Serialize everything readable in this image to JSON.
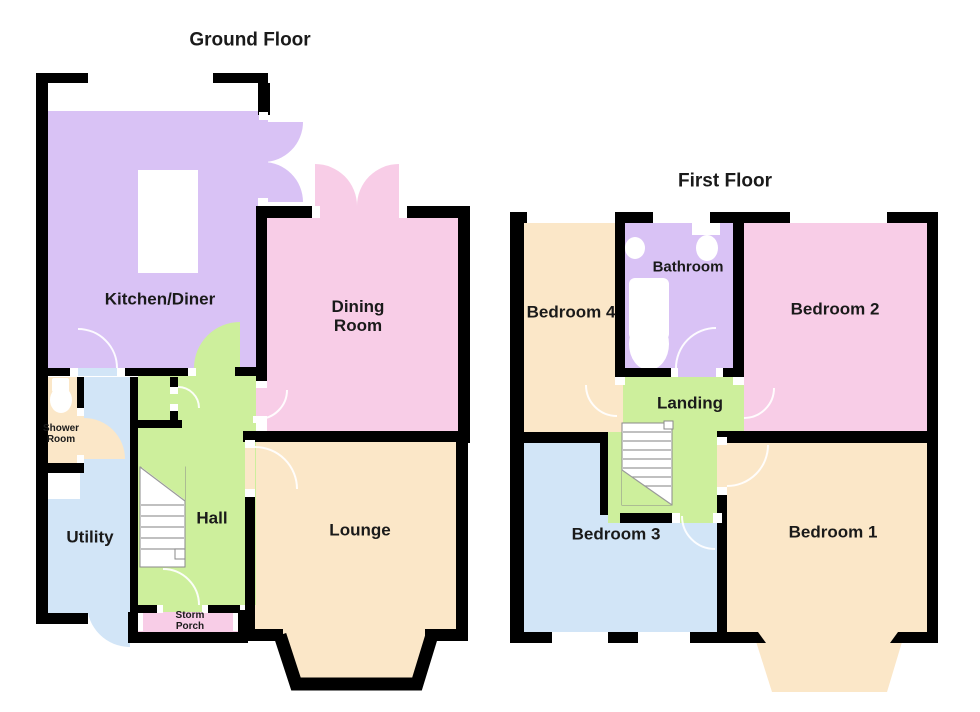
{
  "ground_floor": {
    "title": "Ground Floor",
    "rooms": {
      "kitchen": "Kitchen/Diner",
      "dining": "Dining\nRoom",
      "lounge": "Lounge",
      "hall": "Hall",
      "utility": "Utility",
      "shower_room": "Shower\nRoom",
      "storm_porch": "Storm\nPorch"
    }
  },
  "first_floor": {
    "title": "First Floor",
    "rooms": {
      "bedroom4": "Bedroom 4",
      "bathroom": "Bathroom",
      "bedroom2": "Bedroom 2",
      "landing": "Landing",
      "bedroom3": "Bedroom 3",
      "bedroom1": "Bedroom 1"
    }
  },
  "colors": {
    "kitchen_lavender": "#d9c2f5",
    "dining_pink": "#f8cde7",
    "lounge_tan": "#fbe7c8",
    "hall_green": "#cdef9c",
    "utility_blue": "#d2e5f7",
    "wall_black": "#000000",
    "text": "#1a1a1a"
  }
}
